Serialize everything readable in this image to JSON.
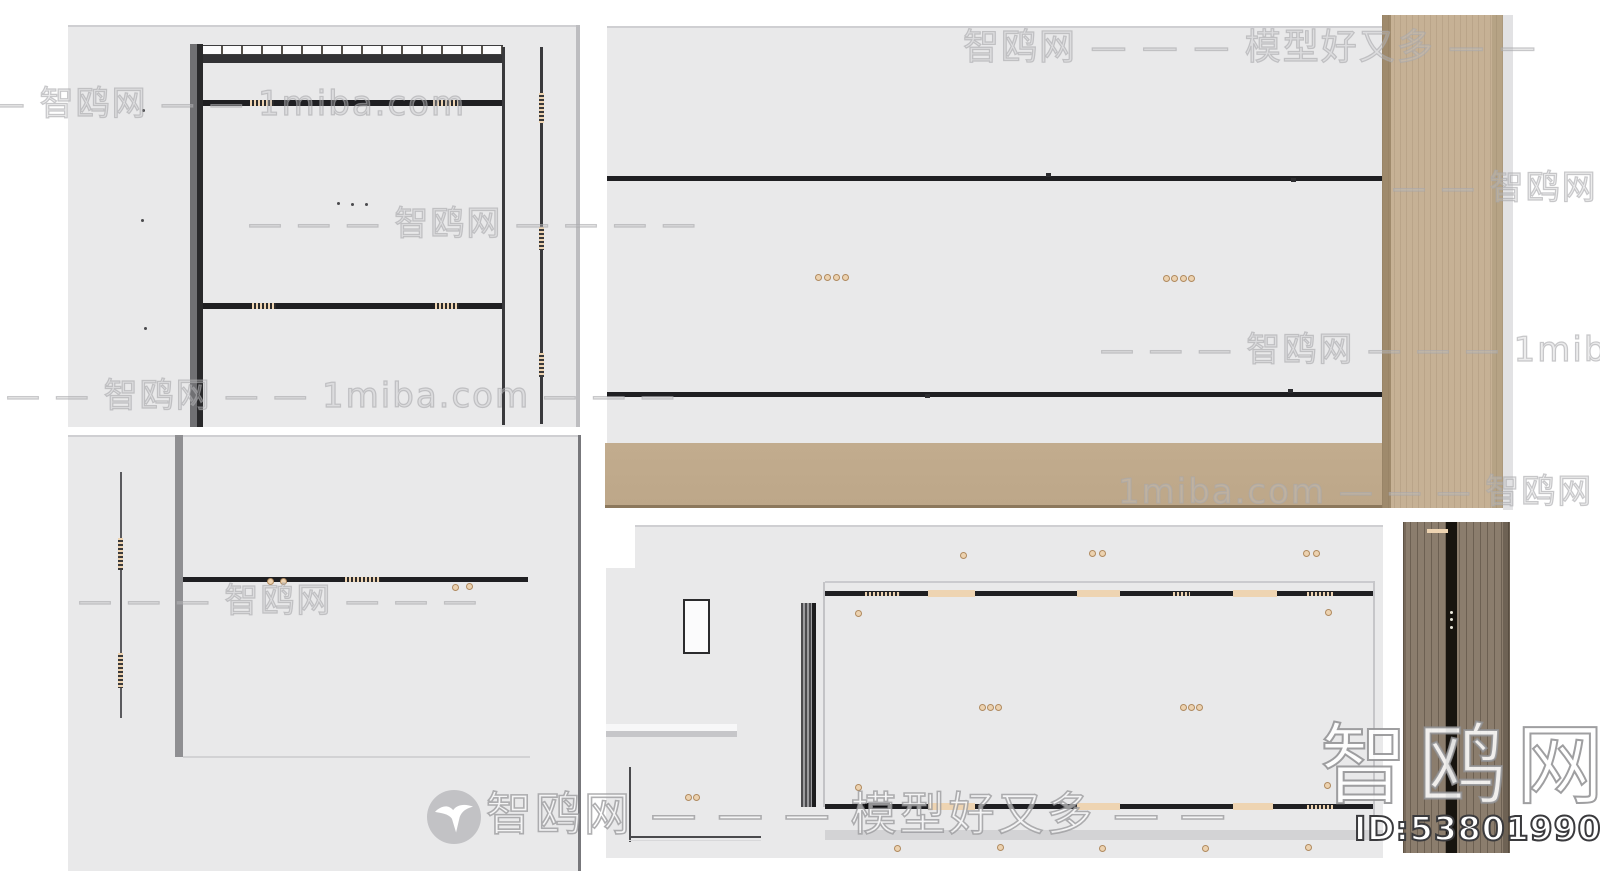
{
  "watermarks": {
    "brand": "智鸥网",
    "site": "1miba.com",
    "slogan": "模型好又多",
    "rows": [
      {
        "text": "智鸥网 — — — 模型好又多 — —"
      },
      {
        "text": "— — 智鸥网 — — 1miba.com"
      },
      {
        "text": "— — 智鸥网 — —"
      },
      {
        "text": "— — — 智鸥网 — — — —"
      },
      {
        "text": "— — — 智鸥网 — — — 1miba.com"
      },
      {
        "text": "— — 智鸥网 — — 1miba.com — — —"
      },
      {
        "text": "1miba.com — — — 智鸥网 — — —"
      },
      {
        "text": "— — — 智鸥网 — — —"
      }
    ],
    "footer_text": "智鸥网 — — — 模型好又多 — —",
    "corner_brand": "智鸥网",
    "model_id": "ID:538019907"
  },
  "colors": {
    "panel": "#e9e9ea",
    "panel_shadow": "#cfcfd2",
    "line_dark": "#1f1f22",
    "bar_gray": "#8f8f92",
    "wood_light": "#c6b195",
    "wood_light_edge": "#9f8a6c",
    "wood_bar": "#bda789",
    "wood_dark": "#8b7d6d",
    "wood_dark_stripe": "#17140f",
    "tan_segment": "#eed4b2",
    "dot_tan": "#ecd2b0",
    "dot_ring": "#b08a5f",
    "id_outline": "#3a3a3d"
  },
  "decor": {
    "tan_dots": [
      [
        818,
        277
      ],
      [
        827,
        277
      ],
      [
        836,
        277
      ],
      [
        845,
        277
      ],
      [
        1166,
        278
      ],
      [
        1174,
        278
      ],
      [
        1183,
        278
      ],
      [
        1191,
        278
      ],
      [
        963,
        555
      ],
      [
        1092,
        553
      ],
      [
        1102,
        553
      ],
      [
        1306,
        553
      ],
      [
        1316,
        553
      ],
      [
        858,
        613
      ],
      [
        1328,
        612
      ],
      [
        982,
        707
      ],
      [
        990,
        707
      ],
      [
        998,
        707
      ],
      [
        1183,
        707
      ],
      [
        1191,
        707
      ],
      [
        1199,
        707
      ],
      [
        858,
        787
      ],
      [
        1327,
        785
      ],
      [
        688,
        797
      ],
      [
        696,
        797
      ],
      [
        897,
        848
      ],
      [
        1000,
        847
      ],
      [
        1102,
        848
      ],
      [
        1205,
        848
      ],
      [
        1308,
        847
      ],
      [
        270,
        581
      ],
      [
        283,
        581
      ],
      [
        455,
        587
      ],
      [
        469,
        586
      ]
    ],
    "dark_dots": [
      [
        143,
        110
      ],
      [
        142,
        220
      ],
      [
        145,
        328
      ],
      [
        338,
        203
      ],
      [
        352,
        204
      ],
      [
        366,
        204
      ]
    ],
    "white_dots": [
      [
        1451,
        612
      ],
      [
        1451,
        619
      ],
      [
        1451,
        627
      ]
    ]
  }
}
